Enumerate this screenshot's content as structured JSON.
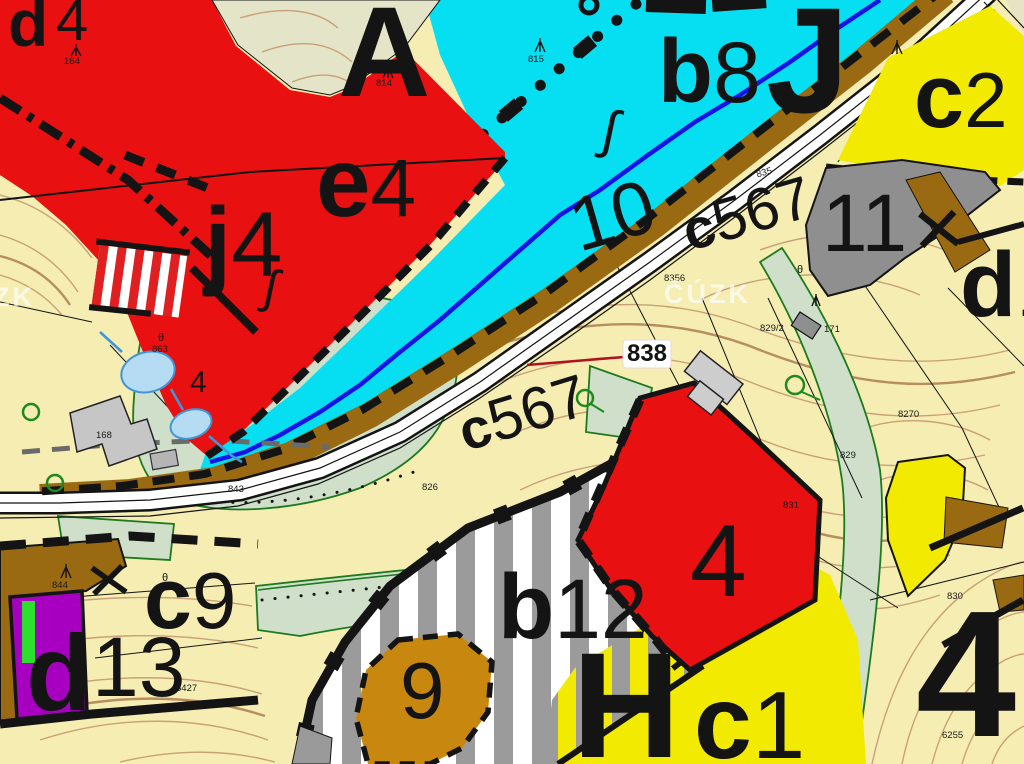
{
  "map": {
    "watermark": "ČÚZK",
    "callout_838": "838",
    "zone_labels": {
      "d4": {
        "b": "d",
        "l": "4"
      },
      "A": {
        "b": "A"
      },
      "b8": {
        "b": "b",
        "l": "8"
      },
      "J": {
        "b": "J"
      },
      "c2": {
        "b": "c",
        "l": "2"
      },
      "e4": {
        "b": "e",
        "l": "4"
      },
      "j4": {
        "b": "j",
        "l": "4"
      },
      "n10": {
        "l": "10"
      },
      "c567_upper": {
        "b": "c",
        "l": "567"
      },
      "n11": {
        "l": "11"
      },
      "d1": {
        "b": "d",
        "l": "1"
      },
      "c567_lower": {
        "b": "c",
        "l": "567"
      },
      "n4_red": {
        "l": "4"
      },
      "c9": {
        "b": "c",
        "l": "9"
      },
      "d13": {
        "b": "d",
        "l": "13"
      },
      "b12": {
        "b": "b",
        "l": "12"
      },
      "n9": {
        "l": "9"
      },
      "H": {
        "b": "H"
      },
      "c1": {
        "b": "c",
        "l": "1"
      },
      "n4_big": {
        "b": "4"
      }
    },
    "parcels": [
      {
        "n": "835"
      },
      {
        "n": "8356"
      },
      {
        "n": "829/2"
      },
      {
        "n": "8270"
      },
      {
        "n": "829"
      },
      {
        "n": "831"
      },
      {
        "n": "830"
      },
      {
        "n": "6255"
      },
      {
        "n": "844"
      },
      {
        "n": "8427"
      },
      {
        "n": "843"
      },
      {
        "n": "863"
      },
      {
        "n": "826"
      },
      {
        "n": "168"
      },
      {
        "n": "171"
      },
      {
        "n": "814"
      },
      {
        "n": "815"
      },
      {
        "n": "164"
      }
    ],
    "symbols": {
      "theta": "θ",
      "stream_sign": "∫",
      "green_four": "4"
    },
    "colors": {
      "red": "#e81010",
      "cyan": "#06dff2",
      "yellow": "#f2ea00",
      "pale_field": "#f5edb2",
      "pale_green": "#cfdfca",
      "olive": "#e4e4c9",
      "brown": "#9a6a12",
      "brown_light": "#c8870e",
      "gray_zone": "#8f8f8f",
      "stripe_gray": "#9b9b9b",
      "purple": "#a800c0",
      "bright_green": "#2ee02e",
      "water_fill": "#b5dcf2",
      "water_stroke": "#3f97d9",
      "stream_blue": "#1414e8",
      "contour": "#c9a176",
      "callout_red": "#b01222"
    }
  }
}
